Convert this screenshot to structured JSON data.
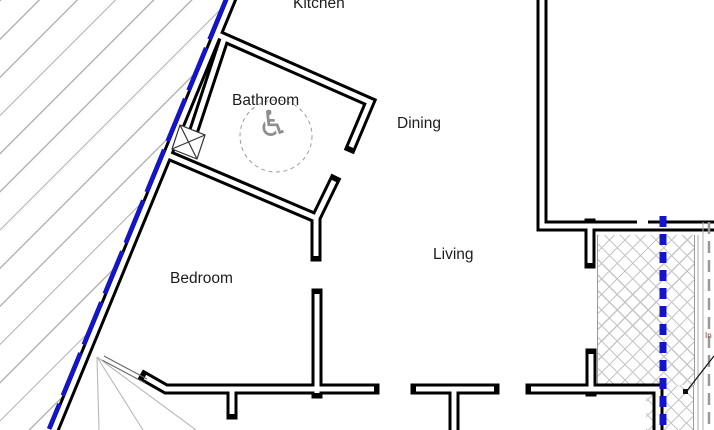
{
  "drawing": {
    "type_label": "accessible-flat-floor-plan"
  },
  "rooms": [
    {
      "label": "Kitchen"
    },
    {
      "label": "Bathroom"
    },
    {
      "label": "Dining"
    },
    {
      "label": "Living"
    },
    {
      "label": "Bedroom"
    }
  ],
  "bathroom_symbol": {
    "icon": "wheelchair-accessible-icon",
    "glyph": "♿"
  },
  "annotation": {
    "leader_text_fragment": "In"
  },
  "colors": {
    "wall_black": "#000000",
    "boundary_blue": "#1414cc",
    "site_hatch_gray": "#b4b4b4",
    "crosshatch_gray": "#c6c6c6",
    "dashed_edge_gray": "#999999",
    "annotation_red": "#993322"
  }
}
